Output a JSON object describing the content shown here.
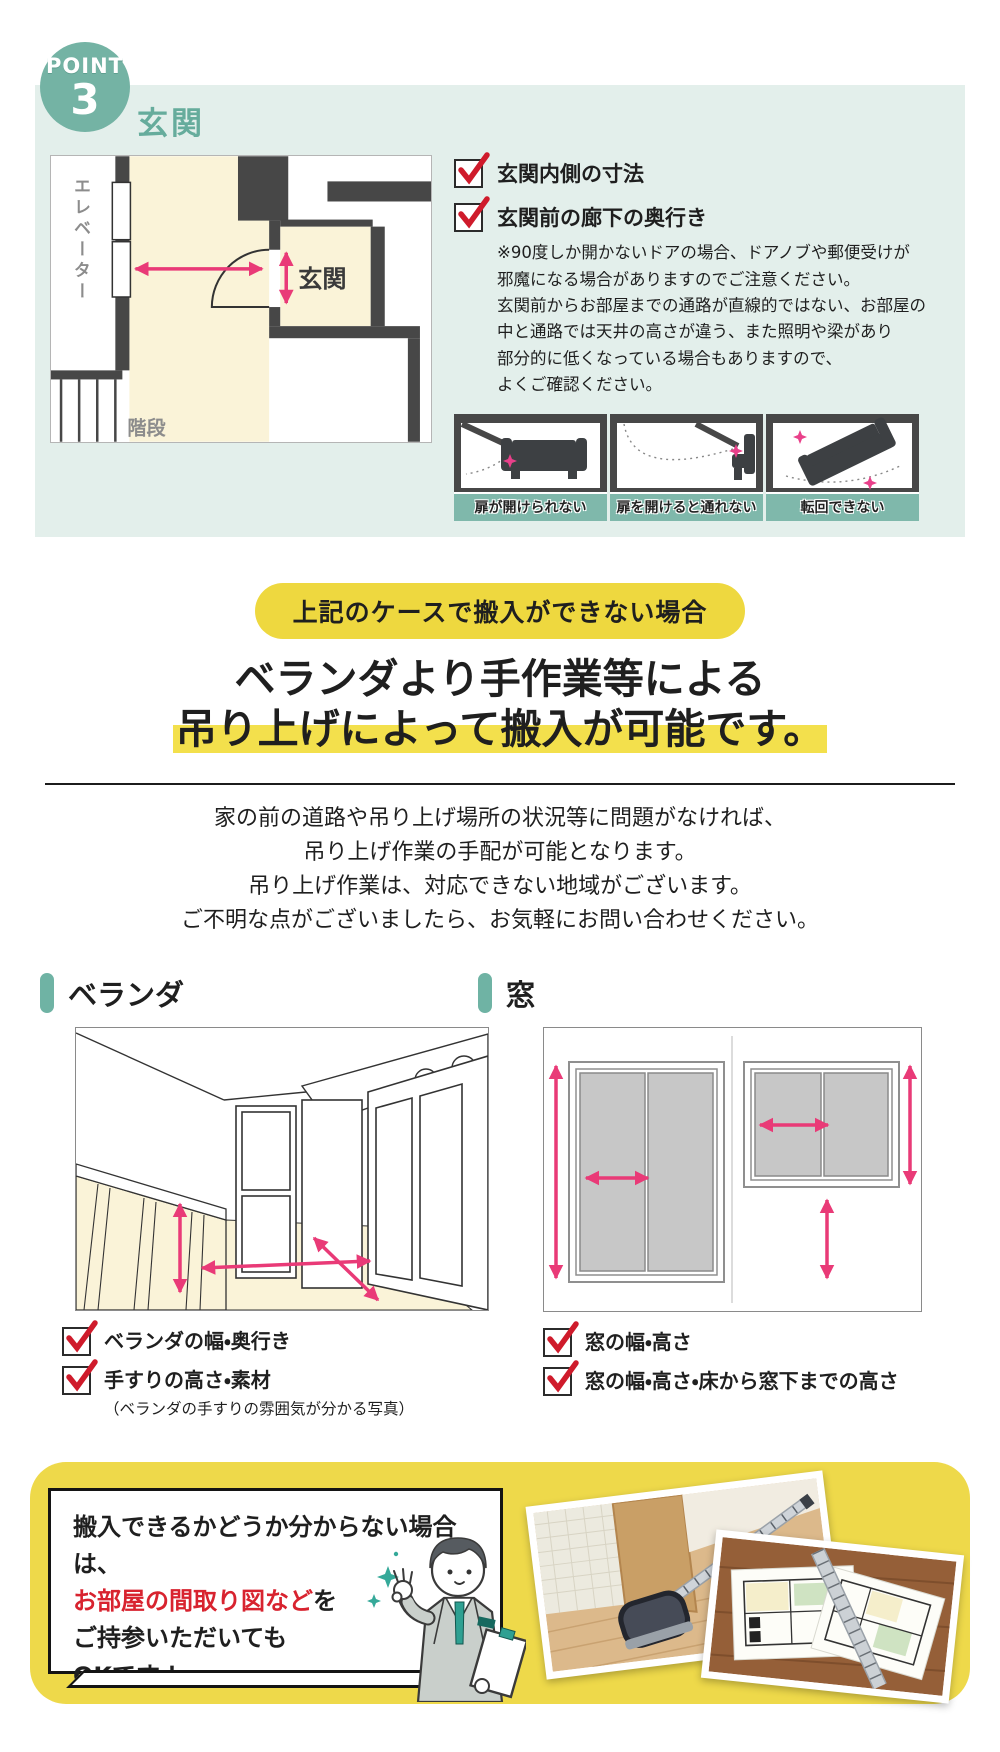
{
  "point": {
    "label": "POINT",
    "number": "3",
    "title": "玄関",
    "floorplan": {
      "elevator_label": "エレベーター",
      "entrance_label": "玄関",
      "stairs_label": "階段"
    },
    "checklist": [
      {
        "label": "玄関内側の寸法"
      },
      {
        "label": "玄関前の廊下の奥行き"
      }
    ],
    "note_lines": [
      "※90度しか開かないドアの場合、ドアノブや郵便受けが",
      "邪魔になる場合がありますのでご注意ください。",
      "玄関前からお部屋までの通路が直線的ではない、お部屋の",
      "中と通路では天井の高さが違う、また照明や梁があり",
      "部分的に低くなっている場合もありますので、",
      "よくご確認ください。"
    ],
    "diagrams": [
      {
        "caption": "扉が開けられない"
      },
      {
        "caption": "扉を開けると通れない"
      },
      {
        "caption": "転回できない"
      }
    ]
  },
  "case_badge": "上記のケースで搬入ができない場合",
  "heading": {
    "line1": "ベランダより手作業等による",
    "line2": "吊り上げによって搬入が可能です。"
  },
  "description_lines": [
    "家の前の道路や吊り上げ場所の状況等に問題がなければ、",
    "吊り上げ作業の手配が可能となります。",
    "吊り上げ作業は、対応できない地域がございます。",
    "ご不明な点がございましたら、お気軽にお問い合わせください。"
  ],
  "balcony": {
    "title": "ベランダ",
    "checklist": [
      {
        "label": "ベランダの幅・奥行き",
        "note": ""
      },
      {
        "label": "手すりの高さ・素材",
        "note": "（ベランダの手すりの雰囲気が分かる写真）"
      }
    ]
  },
  "window": {
    "title": "窓",
    "checklist": [
      {
        "label": "窓の幅・高さ"
      },
      {
        "label": "窓の幅・高さ・床から窓下までの高さ"
      }
    ]
  },
  "bottom": {
    "line1": "搬入できるかどうか分からない場合は、",
    "line2_red": "お部屋の間取り図など",
    "line2_suffix": "を",
    "line3": "ご持参いただいても",
    "line4": "OKです！"
  },
  "colors": {
    "teal": "#74b3a4",
    "mint_bg": "#e3efeb",
    "pink_arrow": "#e93a77",
    "yellow": "#eed83f",
    "highlight": "#f3e04c",
    "check_red": "#cf1b2b",
    "text_red": "#d8232f",
    "cream": "#faf3d8"
  }
}
